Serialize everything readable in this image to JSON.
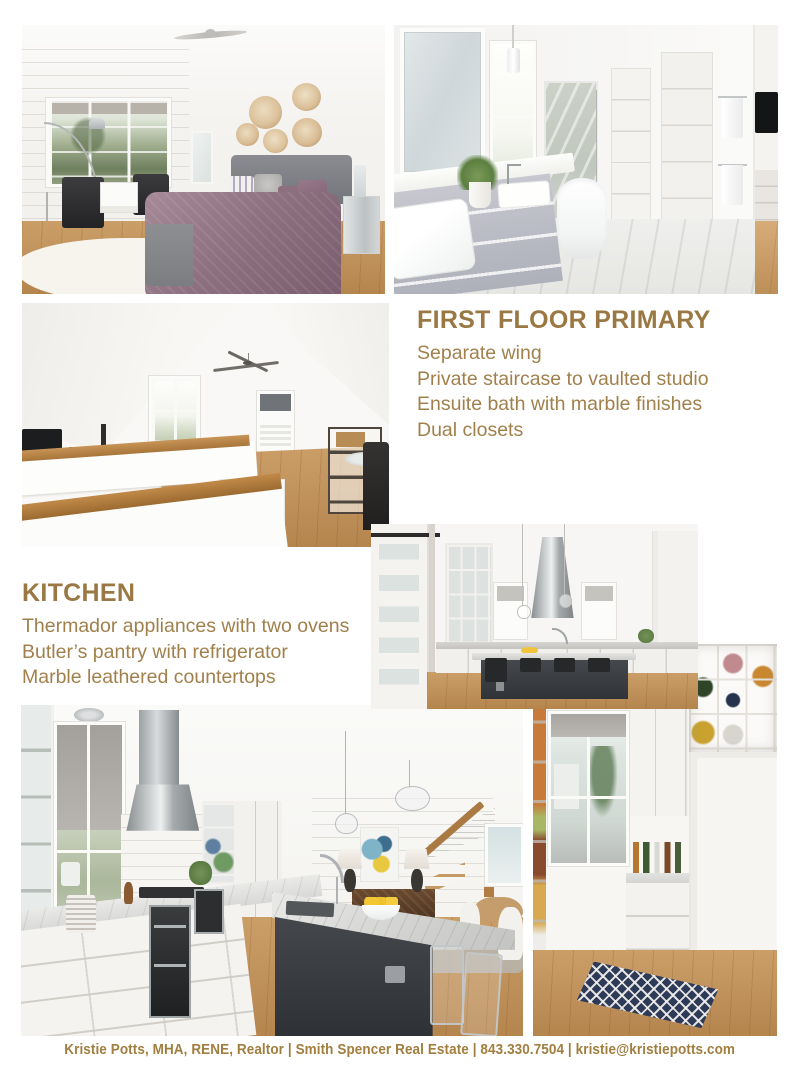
{
  "page": {
    "background": "#ffffff",
    "accent": "#9a7843",
    "body_text_color": "#a1804c",
    "footer_text_color": "#a17e3e"
  },
  "primary_section": {
    "heading": "FIRST FLOOR PRIMARY",
    "features": [
      "Separate wing",
      "Private staircase to vaulted studio",
      "Ensuite bath with marble finishes",
      "Dual closets"
    ]
  },
  "kitchen_section": {
    "heading": "KITCHEN",
    "features": [
      "Thermador appliances with two ovens",
      "Butler’s pantry with refrigerator",
      "Marble leathered countertops"
    ]
  },
  "footer": {
    "text": "Kristie Potts, MHA, RENE, Realtor |  Smith Spencer Real Estate  |  843.330.7504  |  kristie@kristiepotts.com"
  },
  "photos": [
    "primary-bedroom",
    "primary-bathroom",
    "vaulted-studio",
    "kitchen-island",
    "kitchen-galley",
    "butlers-pantry"
  ]
}
